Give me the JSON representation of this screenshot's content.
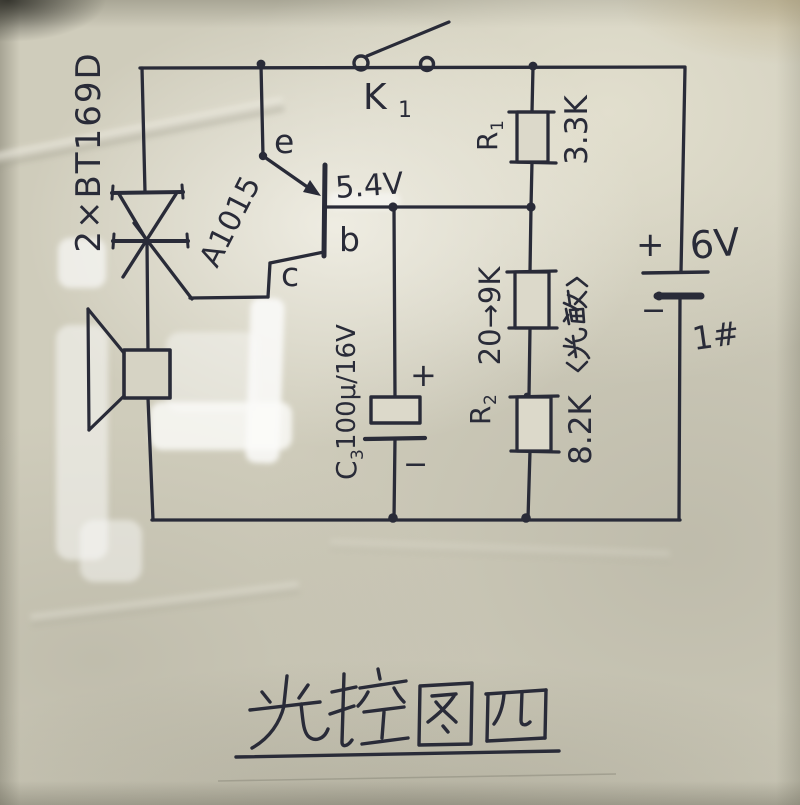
{
  "page": {
    "caption": "光控图四"
  },
  "components": {
    "scr": {
      "part_label": "2×BT169D"
    },
    "transistor": {
      "part_label": "A1015",
      "emitter": "e",
      "base": "b",
      "collector": "c",
      "base_voltage": "5.4V"
    },
    "switch": {
      "ref": "K",
      "ref_sub": "1"
    },
    "r1": {
      "ref": "R",
      "ref_sub": "1",
      "value": "3.3K"
    },
    "photoresistor": {
      "ref": "R",
      "ref_sub": "2",
      "value": "20→9K",
      "note": "〈光敏〉"
    },
    "r3": {
      "value": "8.2K"
    },
    "c3": {
      "ref": "C",
      "ref_sub": "3",
      "value": "100μ/16V",
      "plus": "+",
      "minus": "−"
    },
    "battery": {
      "plus": "+",
      "voltage": "6V",
      "minus": "−",
      "cell_id": "1#"
    }
  },
  "colors": {
    "ink": "#292b38",
    "paper": "#cfccbb"
  }
}
